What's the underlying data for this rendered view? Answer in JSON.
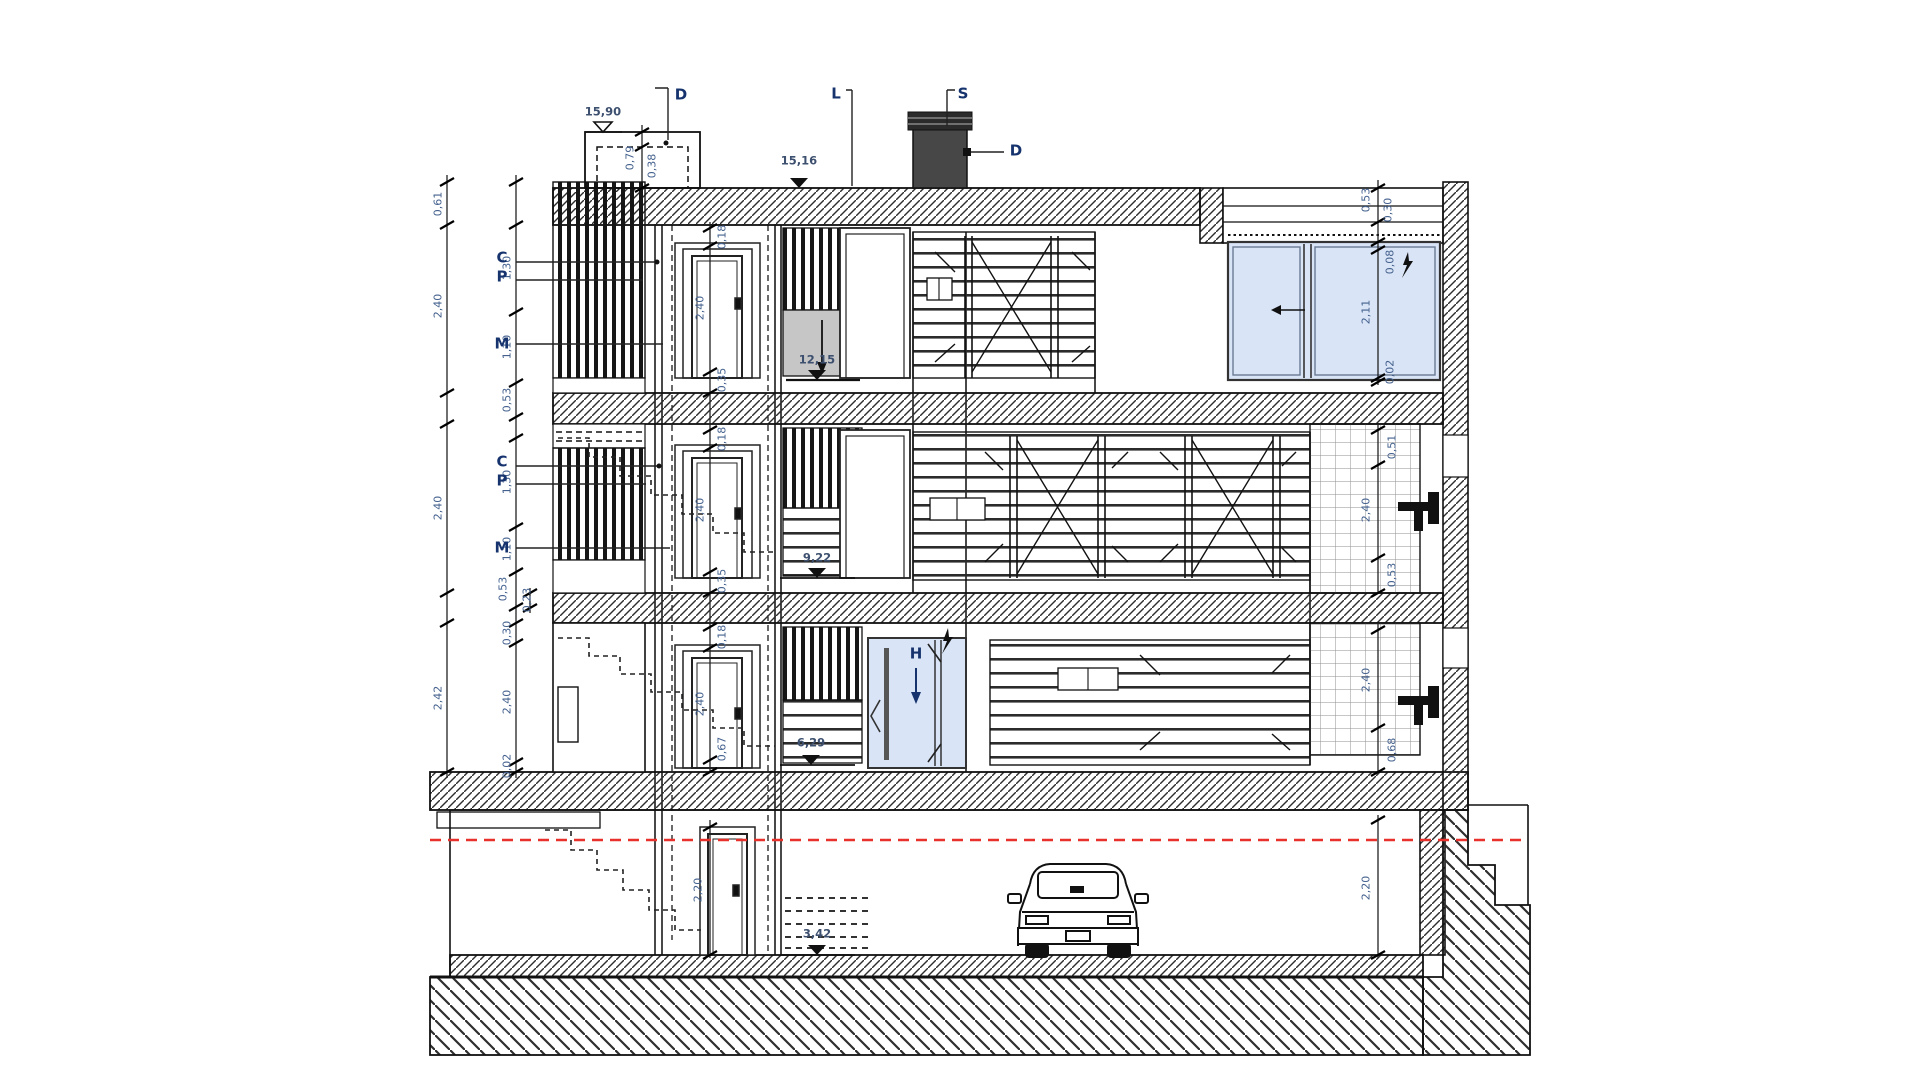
{
  "markers": {
    "c": "C",
    "p": "P",
    "m": "M",
    "d": "D",
    "l": "L",
    "s": "S",
    "h": "H"
  },
  "levels": {
    "bulkhead": "15,90",
    "roof": "15,16",
    "floor3": "12,15",
    "floor2": "9,22",
    "floor1": "6,29",
    "basement": "3,42"
  },
  "dims": {
    "left_parapet": "0,61",
    "left_f3_total": "2,40",
    "left_f3_upper": "1,30",
    "left_f3_lower": "1,10",
    "left_f3_sill": "0,53",
    "left_f2_total": "2,40",
    "left_f2_upper": "1,30",
    "left_f2_lower": "1,10",
    "left_f2_sill": "0,53",
    "left_f2_extra": "0,23",
    "left_f1_total": "2,42",
    "left_f1_head": "0,30",
    "left_f1_clear": "2,40",
    "left_f1_base": "0,02",
    "bulkhead_height": "0,79",
    "bulkhead_inner": "0,38",
    "f3_door_head": "0,18",
    "f3_door_height": "2,40",
    "f3_door_sill": "0,35",
    "f2_door_head": "0,18",
    "f2_door_height": "2,40",
    "f2_door_sill": "0,35",
    "f1_door_head": "0,18",
    "f1_door_height": "2,40",
    "f1_door_sill": "0,67",
    "basement_door_height": "2,20",
    "right_parapet_outer": "0,53",
    "right_parapet_inner": "0,30",
    "right_win_head": "0,08",
    "right_win_height": "2,11",
    "right_win_sill": "0,02",
    "right_f2_head": "0,51",
    "right_f2_clear": "2,40",
    "right_f2_sill": "0,53",
    "right_f1_clear": "2,40",
    "right_f1_sill": "0,68",
    "right_basement_clear": "2,20"
  },
  "colors": {
    "glass": "#d9e4f6",
    "elevator_car": "#c6c6c6",
    "chimney": "#474747",
    "ground_line": "#e8312a"
  }
}
